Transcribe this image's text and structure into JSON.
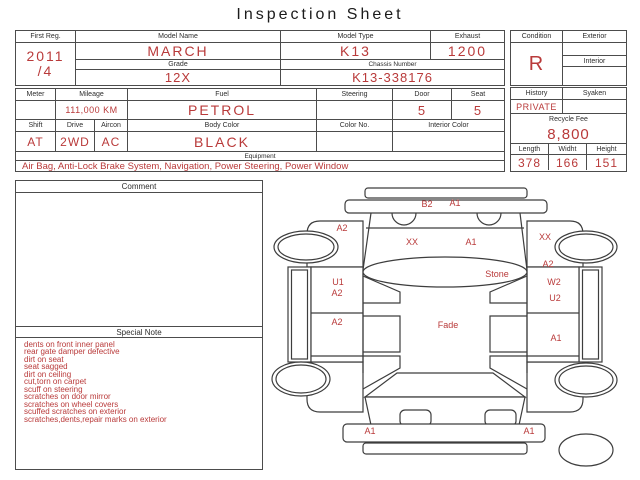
{
  "title": "Inspection Sheet",
  "colors": {
    "accent_red": "#b93a3a",
    "line": "#4c4c4c"
  },
  "top": {
    "first_reg_label": "First Reg.",
    "first_reg_year": "2011",
    "first_reg_month": "/4",
    "model_name_label": "Model Name",
    "model_name": "MARCH",
    "model_type_label": "Model Type",
    "model_type": "K13",
    "exhaust_label": "Exhaust",
    "exhaust": "1200",
    "grade_label": "Grade",
    "grade": "12X",
    "chassis_label": "Chassis Number",
    "chassis": "K13-338176"
  },
  "condition": {
    "condition_label": "Condition",
    "condition": "R",
    "exterior_label": "Exterior",
    "exterior": "",
    "interior_label": "Interior",
    "interior": ""
  },
  "spec": {
    "meter_label": "Meter",
    "meter": "",
    "mileage_label": "Mileage",
    "mileage": "111,000 KM",
    "fuel_label": "Fuel",
    "fuel": "PETROL",
    "steering_label": "Steering",
    "steering": "",
    "door_label": "Door",
    "door": "5",
    "seat_label": "Seat",
    "seat": "5",
    "shift_label": "Shift",
    "shift": "AT",
    "drive_label": "Drive",
    "drive": "2WD",
    "aircon_label": "Aircon",
    "aircon": "AC",
    "body_color_label": "Body Color",
    "body_color": "BLACK",
    "color_no_label": "Color No.",
    "color_no": "",
    "interior_color_label": "Interior Color",
    "interior_color": "",
    "equipment_label": "Equipment",
    "equipment": "Air Bag, Anti-Lock Brake System, Navigation, Power Steering, Power Window"
  },
  "history": {
    "history_label": "History",
    "history": "PRIVATE",
    "syaken_label": "Syaken",
    "syaken": "",
    "recycle_label": "Recycle Fee",
    "recycle_fee": "8,800",
    "length_label": "Length",
    "length": "378",
    "width_label": "Widht",
    "width": "166",
    "height_label": "Height",
    "height": "151"
  },
  "comment": {
    "label": "Comment",
    "text": ""
  },
  "special_note": {
    "label": "Special Note",
    "items": [
      "dents on front inner panel",
      "rear gate damper defective",
      "dirt on seat",
      "seat sagged",
      "dirt on ceiling",
      "cut,torn on carpet",
      "scuff on steering",
      "scratches on door mirror",
      "scratches on wheel covers",
      "scuffed scratches on exterior",
      "scratches,dents,repair marks on exterior"
    ]
  },
  "diagram": {
    "marks": [
      {
        "label": "B2",
        "x": 427,
        "y": 207
      },
      {
        "label": "A1",
        "x": 455,
        "y": 206
      },
      {
        "label": "A2",
        "x": 342,
        "y": 231
      },
      {
        "label": "XX",
        "x": 412,
        "y": 245
      },
      {
        "label": "A1",
        "x": 471,
        "y": 245
      },
      {
        "label": "XX",
        "x": 545,
        "y": 240
      },
      {
        "label": "A2",
        "x": 548,
        "y": 267
      },
      {
        "label": "Stone",
        "x": 497,
        "y": 277
      },
      {
        "label": "U1",
        "x": 338,
        "y": 285
      },
      {
        "label": "A2",
        "x": 337,
        "y": 296
      },
      {
        "label": "W2",
        "x": 554,
        "y": 285
      },
      {
        "label": "U2",
        "x": 555,
        "y": 301
      },
      {
        "label": "A2",
        "x": 337,
        "y": 325
      },
      {
        "label": "Fade",
        "x": 448,
        "y": 328
      },
      {
        "label": "A1",
        "x": 556,
        "y": 341
      },
      {
        "label": "A1",
        "x": 370,
        "y": 434
      },
      {
        "label": "A1",
        "x": 529,
        "y": 434
      }
    ]
  }
}
